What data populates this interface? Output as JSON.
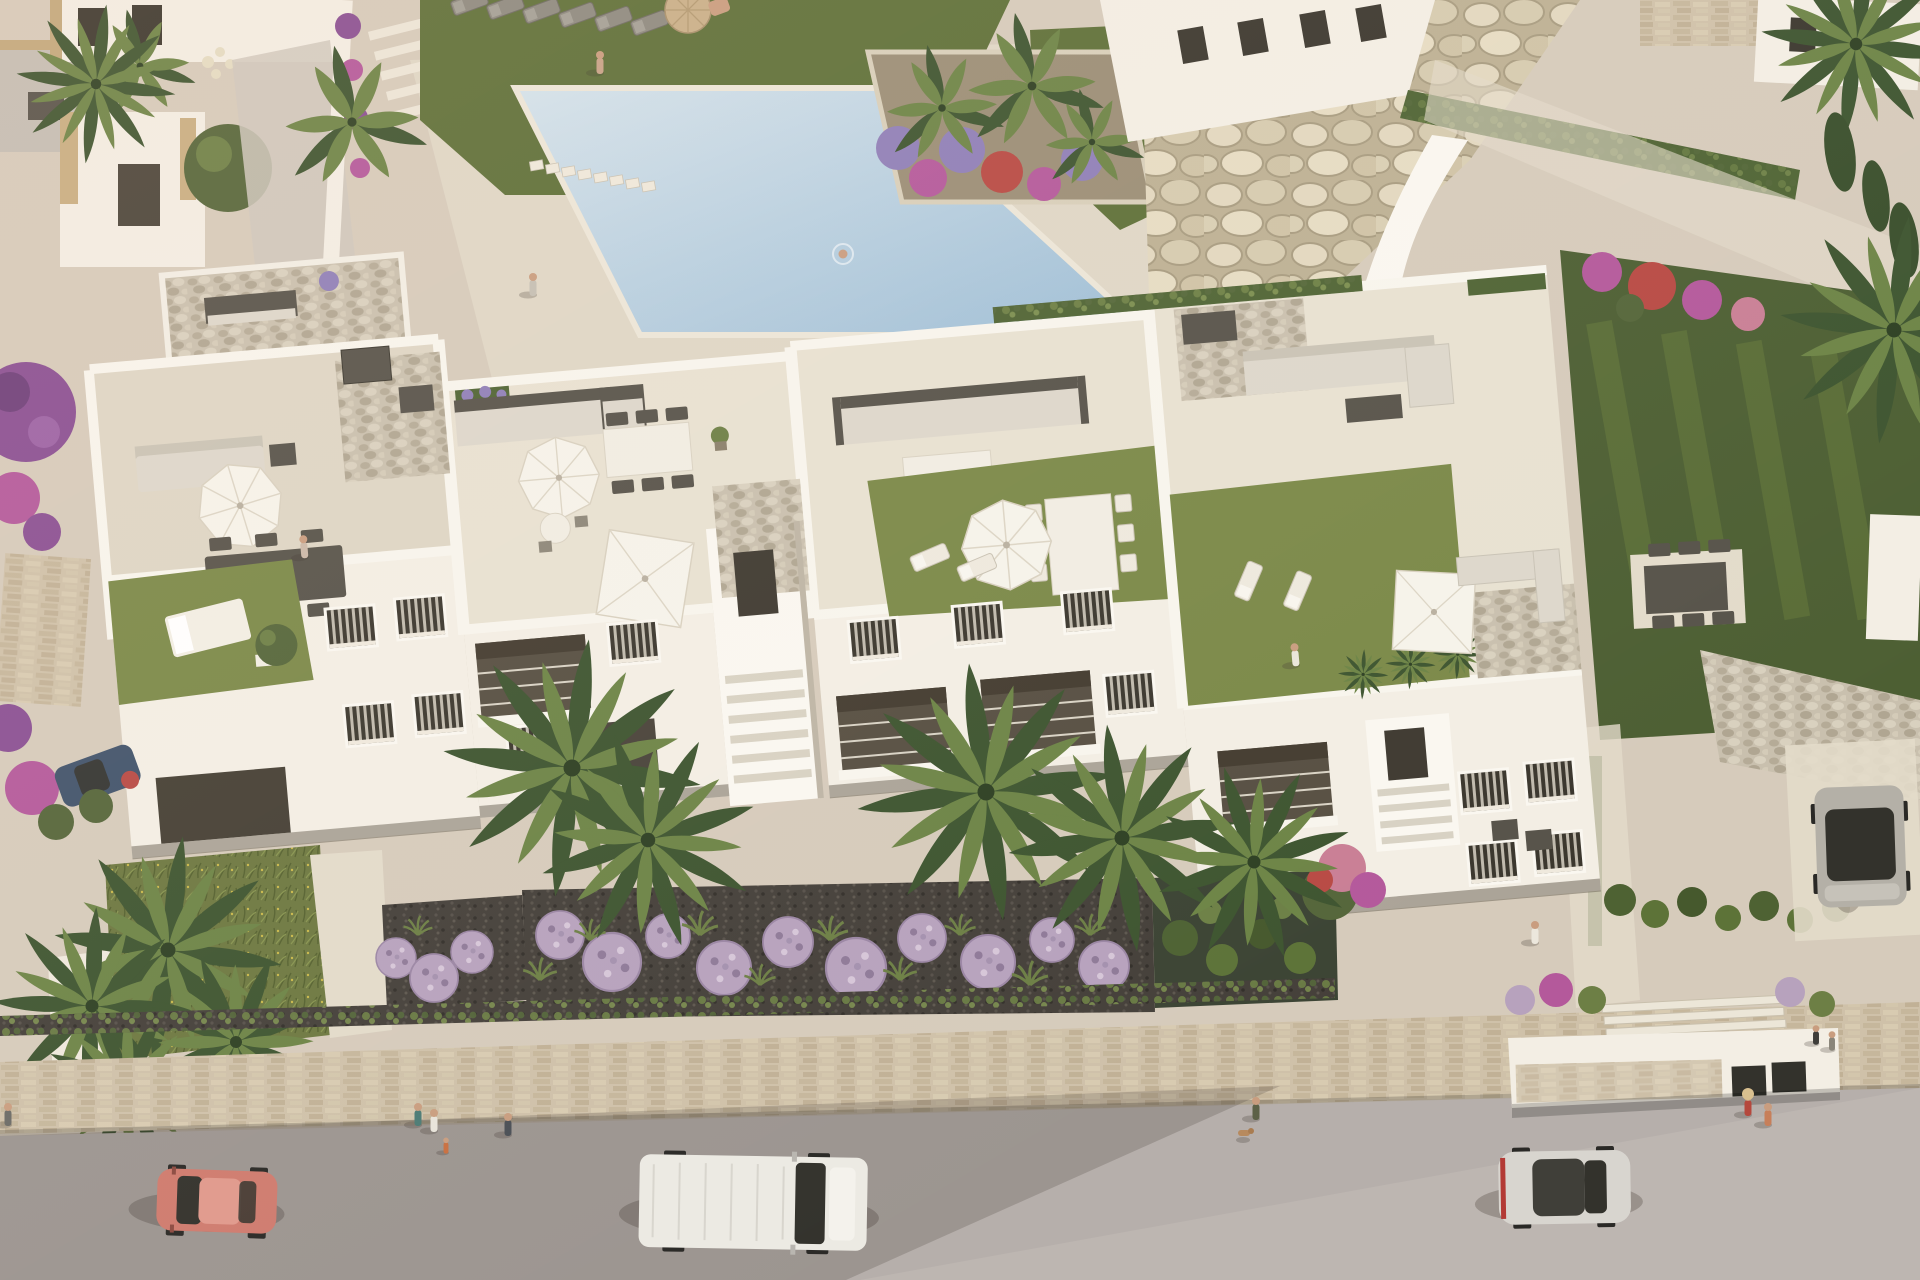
{
  "scene": {
    "kind": "aerial 3d architectural render",
    "subject": "white Mediterranean apartment building with four rooftop terraces, communal pool, gardens, and a street with vehicles",
    "lighting": "late afternoon sun from the upper right, long soft shadows toward lower left"
  },
  "inventory": {
    "vehicles": [
      {
        "id": "red-car",
        "label": "red coupe driving on street",
        "color_key": "car_red"
      },
      {
        "id": "white-van",
        "label": "white panel van on street",
        "color_key": "van_white"
      },
      {
        "id": "silver-car",
        "label": "silver hatchback on street",
        "color_key": "car_silver"
      },
      {
        "id": "dark-parked-car",
        "label": "grey car parked on right driveway",
        "color_key": "car_dark_body"
      },
      {
        "id": "blue-parked-car",
        "label": "dark blue car parked at left",
        "color_key": "car_blue"
      }
    ],
    "building": {
      "blocks": 4,
      "features": [
        "rooftop terraces",
        "white parapets",
        "roof lawns",
        "gravel stair cores",
        "white parasols",
        "outdoor sofas and dining sets",
        "shutter windows",
        "recessed balconies"
      ]
    },
    "amenities": [
      "communal pool with stepping stones",
      "sun lounger lawn",
      "boulder rock garden",
      "palm trees",
      "lavender ball shrubs",
      "boxwood hedge rows",
      "street and stone boundary wall"
    ],
    "people_count": 16,
    "parasols": {
      "white_round": 3,
      "white_square": 2,
      "tan": 1
    }
  },
  "colors": {
    "paving": "#d6cbbb",
    "paving_light": "#e3dbca",
    "street": "#b6afab",
    "wall_shadow": "rgba(55,46,38,0.20)",
    "building_white": "#f3eee4",
    "building_bright": "#faf7f0",
    "building_shade": "#ddd4c4",
    "parapet": "#f8f5ed",
    "facade_recess": "#574f42",
    "glass_dark": "#33322c",
    "roof_floor": "#e8e1d1",
    "roof_floor_dark": "#ded6c5",
    "lawn_roof": "#7b8948",
    "lawn_top": "#5e7038",
    "lawn_right": "#4d5f33",
    "hedge": "#4f6434",
    "shrub": "#6d7f45",
    "tree": "#55663a",
    "palm_dark": "#3e5530",
    "palm_light": "#6d8446",
    "pool_light": "#d4e3ec",
    "pool_deep": "#9dbdd5",
    "pool_coping": "#ece6d8",
    "furn_dark": "#57534a",
    "furn_mid": "#8d8a80",
    "cushion": "#ddd7cb",
    "table_white": "#f1ede3",
    "umbrella": "#f6f3ea",
    "umbrella_tan": "#c9b089",
    "lavender": "#b7a2bd",
    "flower_purple": "#8f7fb8",
    "flower_magenta": "#b4599b",
    "flower_red": "#b84a44",
    "flower_pink": "#c97f95",
    "bougainvillea": "#8a4f93",
    "skin": "#c99d7f",
    "car_red": "#cf7b6e",
    "car_red_roof": "#e0998c",
    "car_blue": "#41536b",
    "van_white": "#eceae3",
    "car_silver": "#d8d5cf",
    "car_dark_body": "#b4b0a7",
    "wheel": "#2a2926",
    "shadow": "rgba(60,50,42,0.28)"
  }
}
